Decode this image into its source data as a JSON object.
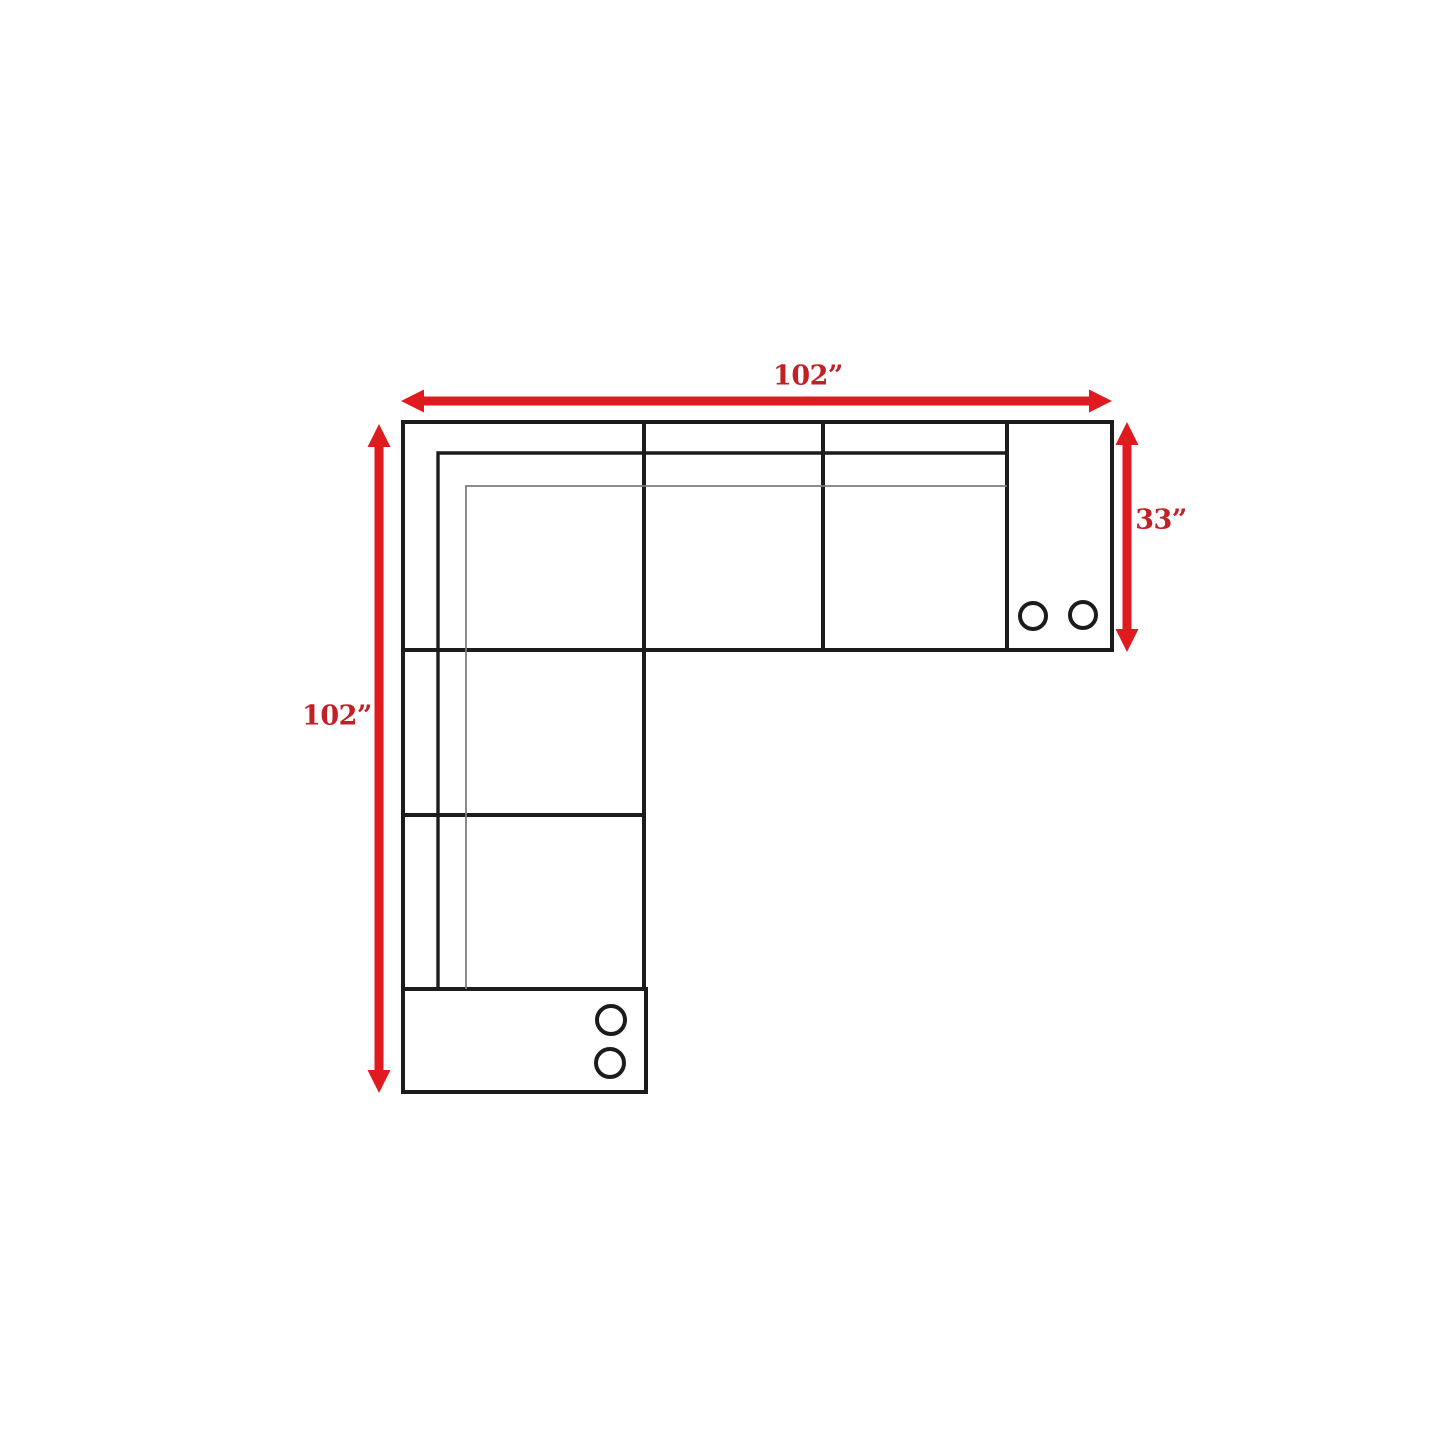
{
  "diagram": {
    "type": "sectional-sofa-dimension-drawing",
    "view": "top-down schematic",
    "dimension_labels": {
      "top_width": "102”",
      "left_height": "102”",
      "right_depth": "33”"
    },
    "colors": {
      "arrow": "#e01b1f",
      "label_text": "#c32026",
      "outline": "#1c1c1c",
      "thin_line": "#7d7d7d",
      "background": "#ffffff"
    }
  }
}
